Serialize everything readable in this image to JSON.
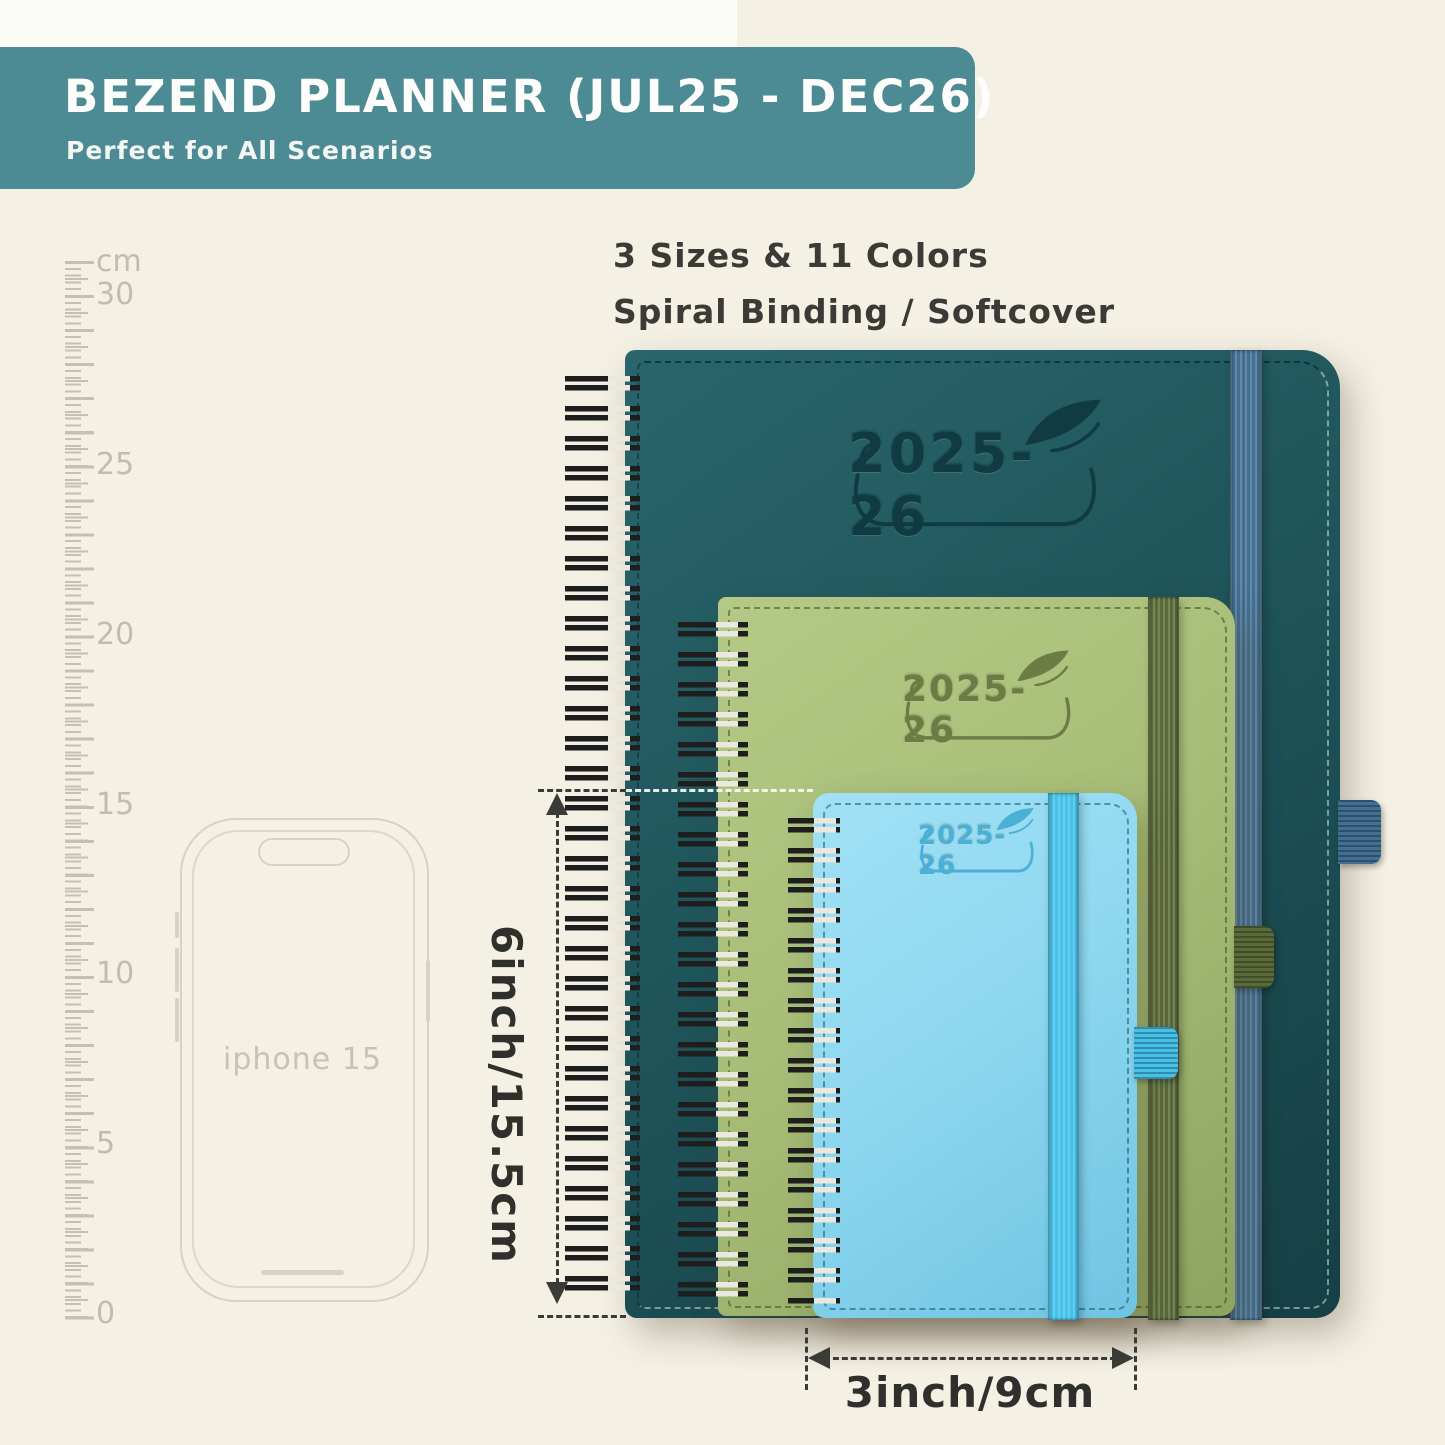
{
  "header": {
    "title": "BEZEND PLANNER (JUL25 - DEC26)",
    "subtitle": "Perfect for All Scenarios"
  },
  "intro": {
    "line1": "3 Sizes & 11 Colors",
    "line2": "Spiral Binding / Softcover"
  },
  "ruler": {
    "labels": [
      "cm",
      "30",
      "25",
      "20",
      "15",
      "10",
      "5",
      "0"
    ]
  },
  "phone": {
    "label": "iphone 15"
  },
  "planners": {
    "large": {
      "year_label": "2025-26"
    },
    "medium": {
      "year_label": "2025-26"
    },
    "small": {
      "year_label": "2025-26"
    }
  },
  "dimensions": {
    "height_label": "6inch/15.5cm",
    "width_label": "3inch/9cm"
  },
  "colors": {
    "cream": "#f4f0e4",
    "banner": "#4c8b94",
    "teal-cover": "#1f565c",
    "teal-logo": "#113b43",
    "steel-blue": "#426f92",
    "green-cover": "#a8be78",
    "green-logo": "#6d7c45",
    "olive": "#5a6a38",
    "blue-cover": "#8ed8f0",
    "blue-logo": "#4ab0d6",
    "bright-blue": "#46c2ea",
    "wire": "#1e1e1e",
    "dim": "#3a3a37",
    "tick": "#c6c0b0",
    "ruler-text": "#c2bcac",
    "phone-line": "#d8d2c4",
    "phone-text": "#c8c2b2"
  }
}
